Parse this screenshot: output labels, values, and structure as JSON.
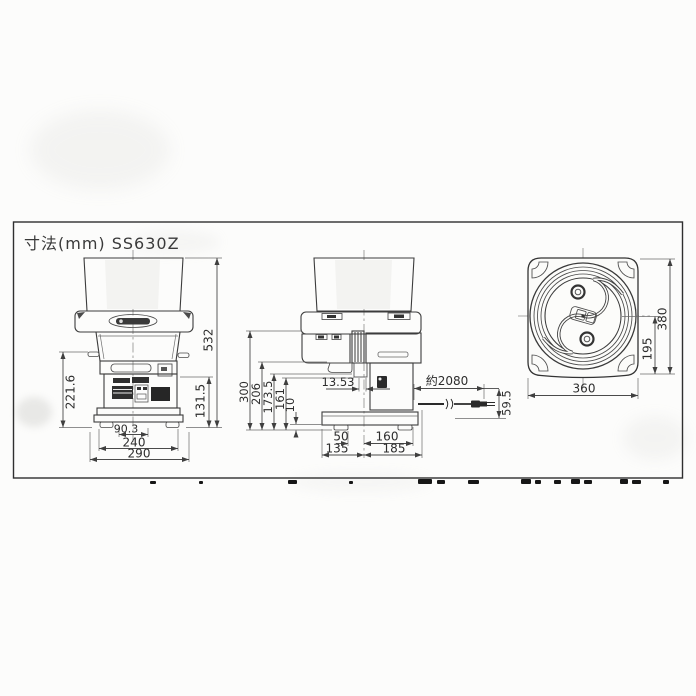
{
  "title": "寸法(mm) SS630Z",
  "front_view": {
    "height_total": "532",
    "height_bowl": "221.6",
    "height_base": "131.5",
    "feet_span": "90.3",
    "feet_width": "240",
    "base_width": "290"
  },
  "side_view": {
    "height_body": "300",
    "height_bowl": "206",
    "height_tray": "173.5",
    "height_spout": "161",
    "base_plate": "10",
    "blade_offset": "13.53",
    "cord_length": "約2080",
    "cord_height": "59.5",
    "center_to_front_foot": "50",
    "center_to_rear": "160",
    "base_front": "135",
    "base_rear": "185"
  },
  "top_view": {
    "depth_total": "380",
    "center_to_rear": "195",
    "width": "360"
  }
}
